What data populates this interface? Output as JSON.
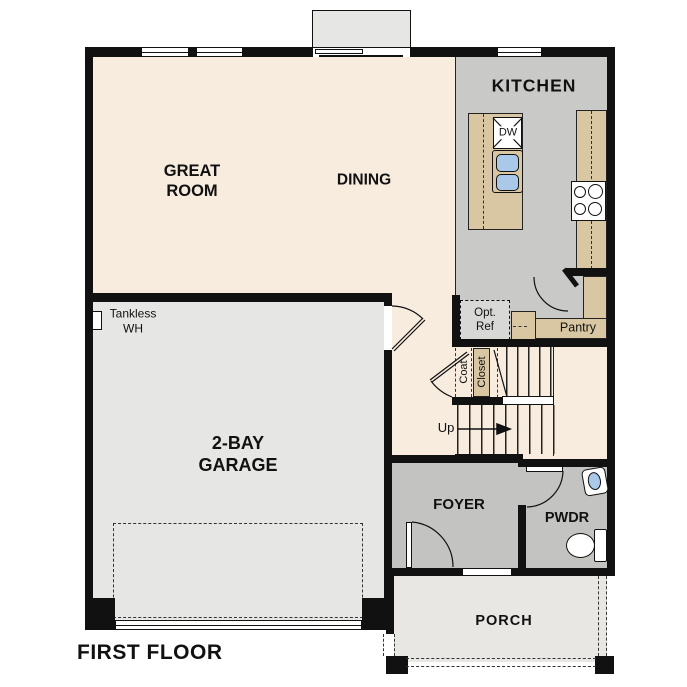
{
  "title": "FIRST FLOOR",
  "rooms": {
    "great_room": "GREAT\nROOM",
    "dining": "DINING",
    "kitchen": "KITCHEN",
    "garage": "2-BAY\nGARAGE",
    "foyer": "FOYER",
    "powder": "PWDR",
    "porch": "PORCH",
    "pantry": "Pantry",
    "coat": "Coat",
    "closet": "Closet"
  },
  "annotations": {
    "stairs_up": "Up",
    "dishwasher": "DW",
    "tankless_water_heater": "Tankless\nWH",
    "optional_refrigerator": "Opt.\nRef"
  },
  "colors": {
    "wall": "#111111",
    "great-room-floor": "#f8ecdf",
    "kitchen-floor": "#c9c9c7",
    "entry-floor": "#c3c3c1",
    "garage-floor": "#e6e6e4",
    "porch-floor": "#e9e7e3",
    "counter": "#d9c6a2",
    "sink": "#aac9e9",
    "fixture": "#ffffff"
  }
}
